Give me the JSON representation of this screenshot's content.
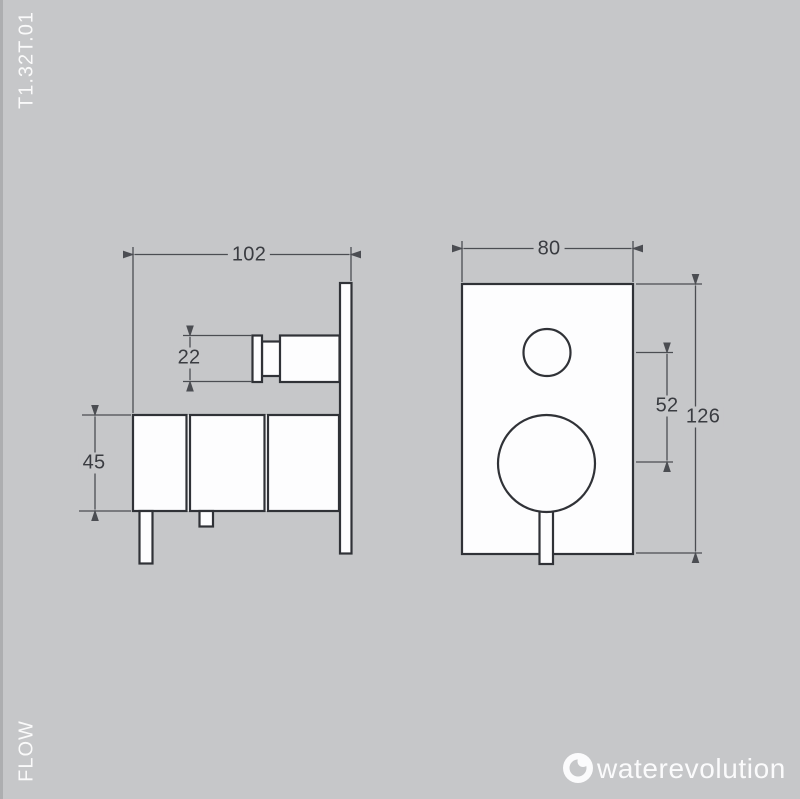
{
  "sheet": {
    "product_code": "T1.32T.01",
    "flow_label": "FLOW",
    "brand": "waterevolution",
    "background_color": "#c6c7c9",
    "outline_color": "#303237",
    "dimension_line_color": "#4b4d52",
    "dimension_text_color": "#3a3c41",
    "fill_color": "#fdfdfe",
    "corner_text_color": "#fafafa"
  },
  "side_view": {
    "name": "side view",
    "width_mm": "102",
    "knob_height_mm": "22",
    "body_height_mm": "45"
  },
  "front_view": {
    "name": "front view",
    "width_mm": "80",
    "circle_offset_mm": "52",
    "height_mm": "126"
  }
}
